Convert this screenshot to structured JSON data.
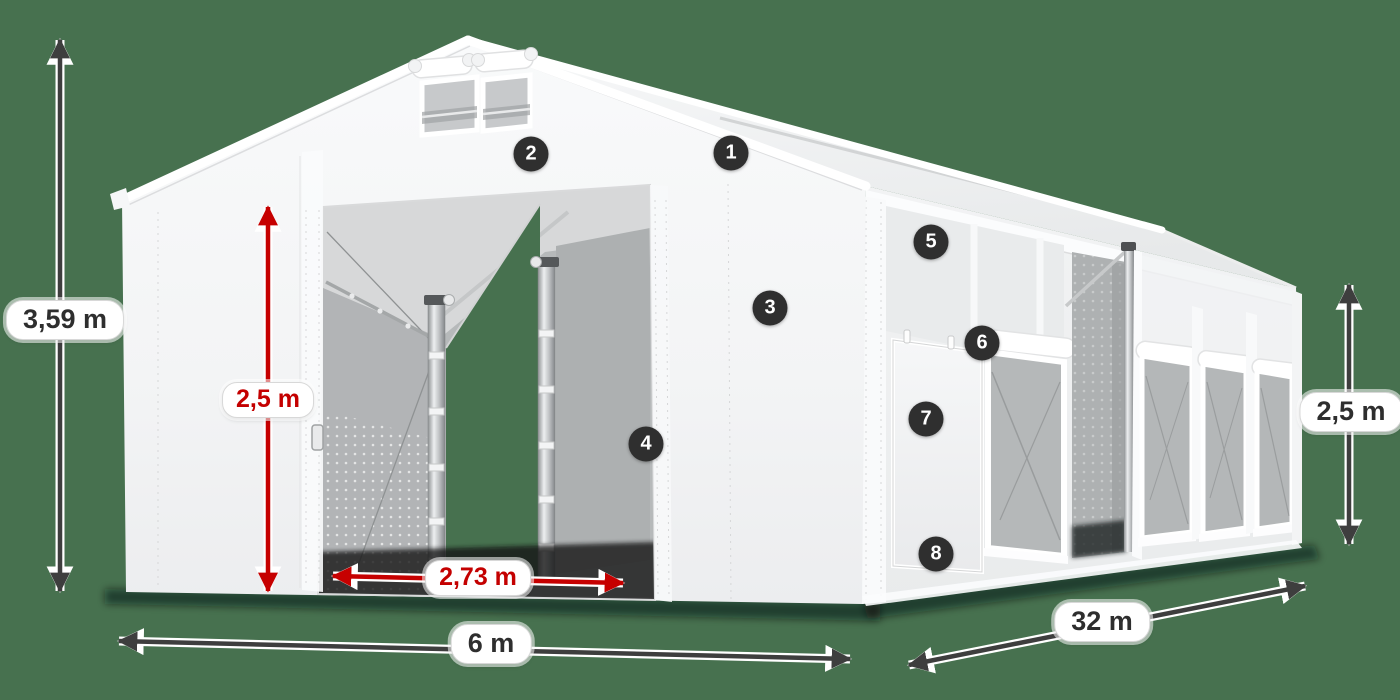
{
  "scene": {
    "background_color": "#47714F",
    "subject": "white storage tent product render with dimension annotations"
  },
  "dimensions": {
    "total_height": {
      "label": "3,59 m",
      "style": "dark",
      "orientation": "vertical-left"
    },
    "entrance_height": {
      "label": "2,5 m",
      "style": "red",
      "orientation": "vertical-entrance"
    },
    "entrance_width": {
      "label": "2,73 m",
      "style": "red",
      "orientation": "horizontal-entrance"
    },
    "front_width": {
      "label": "6 m",
      "style": "dark",
      "orientation": "horizontal-front"
    },
    "side_length": {
      "label": "32 m",
      "style": "dark",
      "orientation": "diagonal-side"
    },
    "side_wall_height": {
      "label": "2,5 m",
      "style": "dark",
      "orientation": "vertical-right"
    }
  },
  "callouts": [
    {
      "number": "1"
    },
    {
      "number": "2"
    },
    {
      "number": "3"
    },
    {
      "number": "4"
    },
    {
      "number": "5"
    },
    {
      "number": "6"
    },
    {
      "number": "7"
    },
    {
      "number": "8"
    }
  ],
  "colors": {
    "background": "#47714F",
    "dimension_arrow_dark": "#3E3E3E",
    "dimension_arrow_red": "#C60000",
    "pill_background": "#FFFFFF",
    "pill_text_dark": "#2E2E2E",
    "pill_text_red": "#C40000",
    "badge_background": "#2F2F2F",
    "badge_text": "#FFFFFF",
    "tent_fabric": "#F5F6F7",
    "mesh_gray": "#B5B8B9"
  }
}
